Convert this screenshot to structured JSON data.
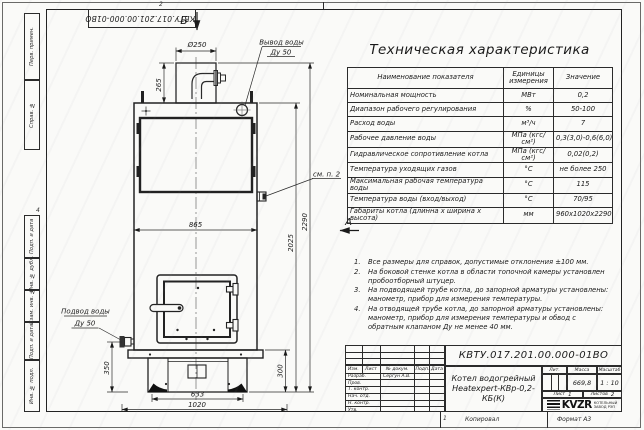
{
  "frame": {
    "zone_top": "2",
    "zone_left": "4",
    "zone_bottom": "1",
    "copied_label": "Копировал",
    "format_label": "Формат А3"
  },
  "stamp_top": "КВТУ.017.201.00.000-01ВО",
  "side_labels": {
    "perv": "Перв. примен.",
    "sprav": "Справ. №",
    "podp1": "Подп. и дата",
    "inv_dubl": "Инв. № дубл.",
    "vzam": "Взам. инв. №",
    "podp2": "Подп. и дата",
    "inv_podl": "Инв. № подл."
  },
  "drawing": {
    "view_top": "Б",
    "view_left": "А",
    "labels": {
      "chimney_dia": "Ø250",
      "outlet_line1": "Вывод воды",
      "outlet_line2": "Ду 50",
      "inlet_line1": "Подвод воды",
      "inlet_line2": "Ду 50",
      "see_note": "см. п. 2"
    },
    "dims": {
      "d265": "265",
      "d865": "865",
      "d2025": "2025",
      "d2290": "2290",
      "d350": "350",
      "d300": "300",
      "d633": "633",
      "d1020": "1020"
    }
  },
  "table": {
    "title": "Техническая характеристика",
    "headers": [
      "Наименование показателя",
      "Единицы измерения",
      "Значение"
    ],
    "rows": [
      {
        "name": "Номинальная мощность",
        "unit": "МВт",
        "value": "0,2"
      },
      {
        "name": "Диапазон рабочего регулирования",
        "unit": "%",
        "value": "50-100"
      },
      {
        "name": "Расход воды",
        "unit": "м³/ч",
        "value": "7"
      },
      {
        "name": "Рабочее давление воды",
        "unit": "МПа (кгс/см²)",
        "value": "0,3(3,0)-0,6(6,0)"
      },
      {
        "name": "Гидравлическое сопротивление котла",
        "unit": "МПа (кгс/см²)",
        "value": "0,02(0,2)"
      },
      {
        "name": "Температура уходящих газов",
        "unit": "°С",
        "value": "не более 250"
      },
      {
        "name": "Максимальная рабочая температура воды",
        "unit": "°С",
        "value": "115"
      },
      {
        "name": "Температура воды (вход/выход)",
        "unit": "°С",
        "value": "70/95"
      },
      {
        "name": "Габариты котла (длинна х ширина х высота)",
        "unit": "мм",
        "value": "960х1020х2290"
      }
    ]
  },
  "notes": {
    "items": [
      {
        "num": "1.",
        "text": "Все размеры для справок, допустимые отклонения ±100 мм."
      },
      {
        "num": "2.",
        "text": "На боковой стенке котла в области топочной камеры установлен пробоотборный штуцер."
      },
      {
        "num": "3.",
        "text": "На подводящей трубе котла, до запорной арматуры установлены: манометр, прибор для измерения температуры."
      },
      {
        "num": "4.",
        "text": "На отводящей трубе котла, до запорной арматуры установлены: манометр, прибор для измерения температуры и обвод с обратным клапаном Ду не менее 40 мм."
      }
    ]
  },
  "title_block": {
    "doc_number": "КВТУ.017.201.00.000-01ВО",
    "name_line1": "Котел водогрейный",
    "name_line2": "Heatexpert-КВр-0,2-КБ(К)",
    "col_izm": "Изм.",
    "col_list": "Лист",
    "col_dokum": "№ докум.",
    "col_podp": "Подп.",
    "col_data": "Дата",
    "rows": [
      {
        "label": "Разраб.",
        "name": "Сергун А.В."
      },
      {
        "label": "Пров.",
        "name": ""
      },
      {
        "label": "Т. контр.",
        "name": ""
      },
      {
        "label": "Нач. отд.",
        "name": ""
      },
      {
        "label": "Н. контр.",
        "name": ""
      },
      {
        "label": "Утв.",
        "name": ""
      }
    ],
    "lit_label": "Лит.",
    "mass_label": "Масса",
    "scale_label": "Масштаб",
    "mass_value": "669,8",
    "scale_value": "1 : 10",
    "sheet_label": "Лист",
    "sheet_value": "1",
    "sheets_label": "Листов",
    "sheets_value": "2",
    "logo_text": "KVZR",
    "logo_sub1": "КОТЕЛЬНЫЙ",
    "logo_sub2": "ЗАВОД РЭП"
  }
}
